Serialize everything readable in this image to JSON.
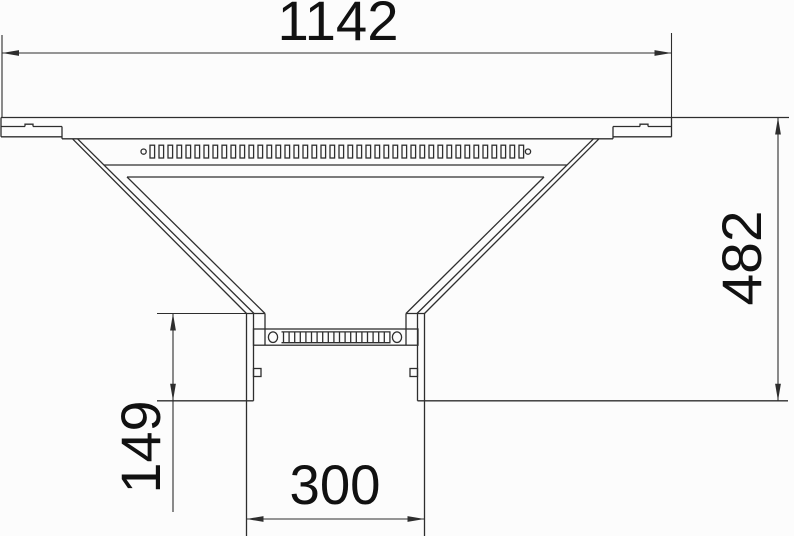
{
  "drawing": {
    "type": "technical-dimension-drawing",
    "dimensions": {
      "top_width": "1142",
      "right_height": "482",
      "left_branch_height": "149",
      "bottom_branch_width": "300"
    },
    "colors": {
      "line": "#2e2e2e",
      "text": "#111111",
      "background": "#fcfcfc"
    }
  }
}
